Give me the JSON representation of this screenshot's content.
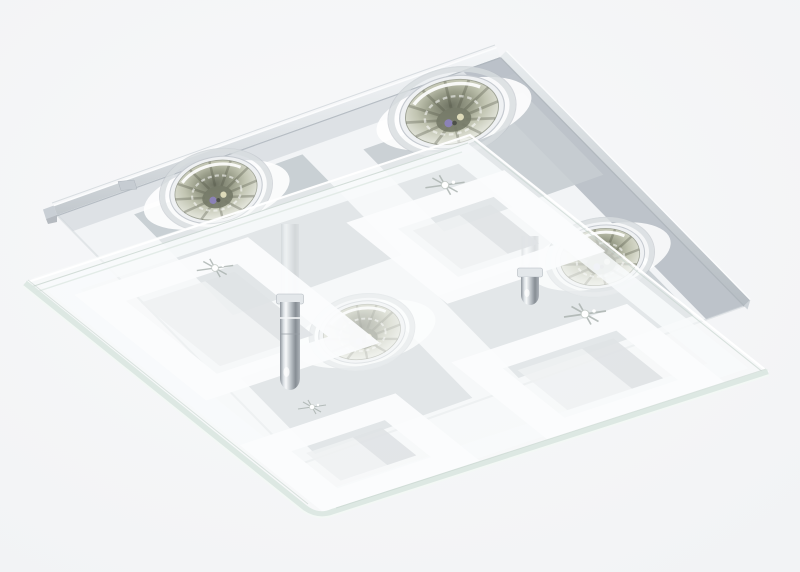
{
  "scene": {
    "subject": "Product photo of a square chrome ceiling light with a satin-glass diffuser decorated with four frosted squares and four halogen GU10 spotlights, viewed from below at an angle",
    "object_type": "ceiling light fixture",
    "style": "modern chrome and partly-satinized clear glass",
    "lamp_count": 4,
    "standoff_count": 2,
    "visible_text": "none",
    "background": "plain light studio gray"
  },
  "components": {
    "mounting_plate": "square chromed steel canopy with mirrored checker reflections",
    "glass_diffuser": "square clear glass panel with white satin border band and four satin square frames",
    "bulbs": [
      "back spotlight",
      "left spotlight",
      "right spotlight",
      "center spotlight"
    ],
    "posts": [
      "left chrome standoff with dome cap",
      "right chrome standoff with dome cap"
    ]
  },
  "palette": {
    "background": "#f5f6f7",
    "plate_white": "#f2f4f6",
    "plate_gray": "#c6cdd2",
    "plate_gray_dark": "#b7bec5",
    "rim_light": "#fafbfc",
    "rim_dark": "#aab1b8",
    "frost_white": "#fbfcfd",
    "frost_band": "#f8fafb",
    "frost_interior": "#eff1f2",
    "interior_shadow": "#d3d8dc",
    "glass_edge": "#dbe7e1",
    "glass_edge_bright": "#f3f8f5",
    "glass_edge_dark": "#c9d6d0",
    "chrome_mid": "#cdd3d8",
    "bulb_olive": "#a3a690",
    "bulb_dark": "#767a66",
    "bulb_violet": "#8e83c4",
    "bulb_warm": "#e8e4c2"
  }
}
